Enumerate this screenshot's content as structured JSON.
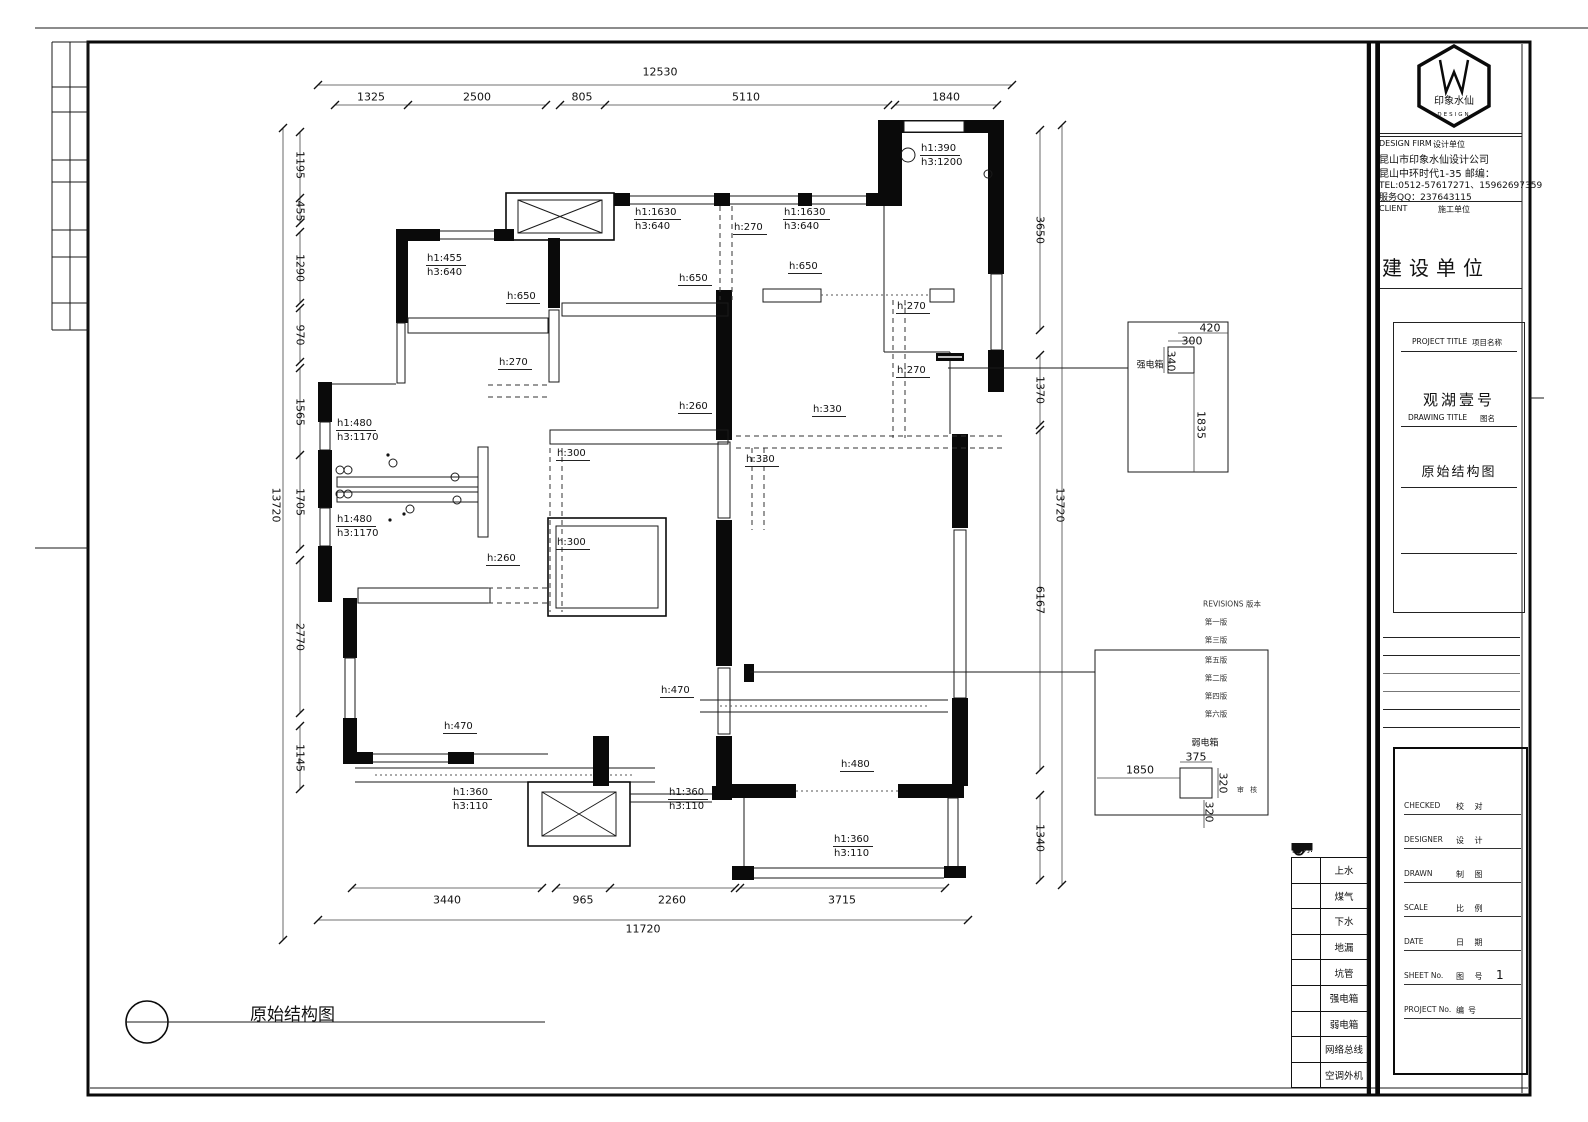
{
  "drawing_label": "原始结构图",
  "plan": {
    "dim_texts": [
      {
        "t": "12530",
        "x": 660,
        "y": 72
      },
      {
        "t": "1325",
        "x": 371,
        "y": 97
      },
      {
        "t": "2500",
        "x": 477,
        "y": 97
      },
      {
        "t": "805",
        "x": 582,
        "y": 97
      },
      {
        "t": "5110",
        "x": 746,
        "y": 97
      },
      {
        "t": "1840",
        "x": 946,
        "y": 97
      },
      {
        "t": "1195",
        "x": 300,
        "y": 165,
        "rot": true
      },
      {
        "t": "455",
        "x": 300,
        "y": 211,
        "rot": true
      },
      {
        "t": "1290",
        "x": 300,
        "y": 268,
        "rot": true
      },
      {
        "t": "970",
        "x": 300,
        "y": 335,
        "rot": true
      },
      {
        "t": "1565",
        "x": 300,
        "y": 412,
        "rot": true
      },
      {
        "t": "1705",
        "x": 300,
        "y": 502,
        "rot": true
      },
      {
        "t": "2770",
        "x": 300,
        "y": 637,
        "rot": true
      },
      {
        "t": "1145",
        "x": 300,
        "y": 758,
        "rot": true
      },
      {
        "t": "13720",
        "x": 276,
        "y": 505,
        "rot": true
      },
      {
        "t": "3650",
        "x": 1040,
        "y": 230,
        "rot": true
      },
      {
        "t": "1370",
        "x": 1040,
        "y": 390,
        "rot": true
      },
      {
        "t": "6167",
        "x": 1040,
        "y": 600,
        "rot": true
      },
      {
        "t": "1340",
        "x": 1040,
        "y": 838,
        "rot": true
      },
      {
        "t": "13720",
        "x": 1060,
        "y": 505,
        "rot": true
      },
      {
        "t": "3440",
        "x": 447,
        "y": 900
      },
      {
        "t": "965",
        "x": 583,
        "y": 900
      },
      {
        "t": "2260",
        "x": 672,
        "y": 900
      },
      {
        "t": "3715",
        "x": 842,
        "y": 900
      },
      {
        "t": "11720",
        "x": 643,
        "y": 929
      },
      {
        "t": "420",
        "x": 1210,
        "y": 328
      },
      {
        "t": "300",
        "x": 1192,
        "y": 341
      },
      {
        "t": "340",
        "x": 1171,
        "y": 361,
        "rot": true
      },
      {
        "t": "1835",
        "x": 1201,
        "y": 425,
        "rot": true
      },
      {
        "t": "强电箱",
        "x": 1150,
        "y": 364,
        "cls": "cn"
      },
      {
        "t": "弱电箱",
        "x": 1205,
        "y": 742,
        "cls": "cn"
      },
      {
        "t": "375",
        "x": 1196,
        "y": 757
      },
      {
        "t": "1850",
        "x": 1140,
        "y": 770
      },
      {
        "t": "320",
        "x": 1223,
        "y": 783,
        "rot": true
      },
      {
        "t": "320",
        "x": 1209,
        "y": 812,
        "rot": true
      },
      {
        "t": "审 核",
        "x": 1248,
        "y": 790,
        "cls": "cnsm"
      },
      {
        "t": "REVISIONS  版本",
        "x": 1232,
        "y": 604,
        "cls": "rev"
      },
      {
        "t": "第一版",
        "x": 1216,
        "y": 622,
        "cls": "rev"
      },
      {
        "t": "第三版",
        "x": 1216,
        "y": 640,
        "cls": "rev"
      },
      {
        "t": "第五版",
        "x": 1216,
        "y": 660,
        "cls": "rev"
      },
      {
        "t": "第二版",
        "x": 1216,
        "y": 678,
        "cls": "rev"
      },
      {
        "t": "第四版",
        "x": 1216,
        "y": 696,
        "cls": "rev"
      },
      {
        "t": "第六版",
        "x": 1216,
        "y": 714,
        "cls": "rev"
      }
    ],
    "annotations": [
      {
        "l": [
          "h1:390",
          "h3:1200"
        ],
        "x": 920,
        "y": 142
      },
      {
        "l": [
          "h1:455",
          "h3:640"
        ],
        "x": 426,
        "y": 252
      },
      {
        "l": [
          "h1:1630",
          "h3:640"
        ],
        "x": 634,
        "y": 206
      },
      {
        "l": [
          "h:270"
        ],
        "x": 733,
        "y": 221
      },
      {
        "l": [
          "h1:1630",
          "h3:640"
        ],
        "x": 783,
        "y": 206
      },
      {
        "l": [
          "h:650"
        ],
        "x": 788,
        "y": 260
      },
      {
        "l": [
          "h:650"
        ],
        "x": 678,
        "y": 272
      },
      {
        "l": [
          "h:650"
        ],
        "x": 506,
        "y": 290
      },
      {
        "l": [
          "h:270"
        ],
        "x": 896,
        "y": 300
      },
      {
        "l": [
          "h:270"
        ],
        "x": 498,
        "y": 356
      },
      {
        "l": [
          "h:270"
        ],
        "x": 896,
        "y": 364
      },
      {
        "l": [
          "h:260"
        ],
        "x": 678,
        "y": 400
      },
      {
        "l": [
          "h:330"
        ],
        "x": 812,
        "y": 403
      },
      {
        "l": [
          "h:300"
        ],
        "x": 556,
        "y": 447
      },
      {
        "l": [
          "h:330"
        ],
        "x": 745,
        "y": 453
      },
      {
        "l": [
          "h1:480",
          "h3:1170"
        ],
        "x": 336,
        "y": 417
      },
      {
        "l": [
          "h1:480",
          "h3:1170"
        ],
        "x": 336,
        "y": 513
      },
      {
        "l": [
          "h:300"
        ],
        "x": 556,
        "y": 536
      },
      {
        "l": [
          "h:260"
        ],
        "x": 486,
        "y": 552
      },
      {
        "l": [
          "h:470"
        ],
        "x": 660,
        "y": 684
      },
      {
        "l": [
          "h:470"
        ],
        "x": 443,
        "y": 720
      },
      {
        "l": [
          "h:480"
        ],
        "x": 840,
        "y": 758
      },
      {
        "l": [
          "h1:360",
          "h3:110"
        ],
        "x": 452,
        "y": 786
      },
      {
        "l": [
          "h1:360",
          "h3:110"
        ],
        "x": 668,
        "y": 786
      },
      {
        "l": [
          "h1:360",
          "h3:110"
        ],
        "x": 833,
        "y": 833
      }
    ]
  },
  "legend": {
    "title": "图例:",
    "items": [
      {
        "icon": "circle-outline",
        "label": "上水"
      },
      {
        "icon": "ellipse-filled",
        "label": "煤气"
      },
      {
        "icon": "circle-cross",
        "label": "下水"
      },
      {
        "icon": "square-filled",
        "label": "地漏"
      },
      {
        "icon": "circle-filled",
        "label": "坑管"
      },
      {
        "icon": "bar-filled",
        "label": "强电箱"
      },
      {
        "icon": "bar-triangle",
        "label": "弱电箱"
      },
      {
        "icon": "rect-diagonal",
        "label": "网络总线"
      },
      {
        "icon": "rect-cross",
        "label": "空调外机"
      }
    ]
  },
  "title_block": {
    "logo_name": "印象水仙",
    "logo_sub": "DESIGN",
    "design_firm_en": "DESIGN FIRM",
    "design_firm_cn": "设计单位",
    "company": "昆山市印象水仙设计公司",
    "address": "昆山中环时代1-35      邮编：",
    "tel": "TEL:0512-57617271、15962697359",
    "qq": "服务QQ：237643115",
    "client_en": "CLIENT",
    "client_cn": "施工单位",
    "client_value": "建设单位",
    "project_title_en": "PROJECT TITLE",
    "project_title_cn": "项目名称",
    "project_title": "观湖壹号",
    "drawing_title_en": "DRAWING TITLE",
    "drawing_title_cn": "图名",
    "drawing_title": "原始结构图",
    "rows": [
      {
        "en": "CHECKED",
        "cn": "校  对",
        "value": ""
      },
      {
        "en": "DESIGNER",
        "cn": "设  计",
        "value": ""
      },
      {
        "en": "DRAWN",
        "cn": "制  图",
        "value": ""
      },
      {
        "en": "SCALE",
        "cn": "比  例",
        "value": ""
      },
      {
        "en": "DATE",
        "cn": "日  期",
        "value": ""
      },
      {
        "en": "SHEET No.",
        "cn": "图  号",
        "value": "1"
      },
      {
        "en": "PROJECT No.",
        "cn": "编号",
        "value": ""
      }
    ]
  }
}
